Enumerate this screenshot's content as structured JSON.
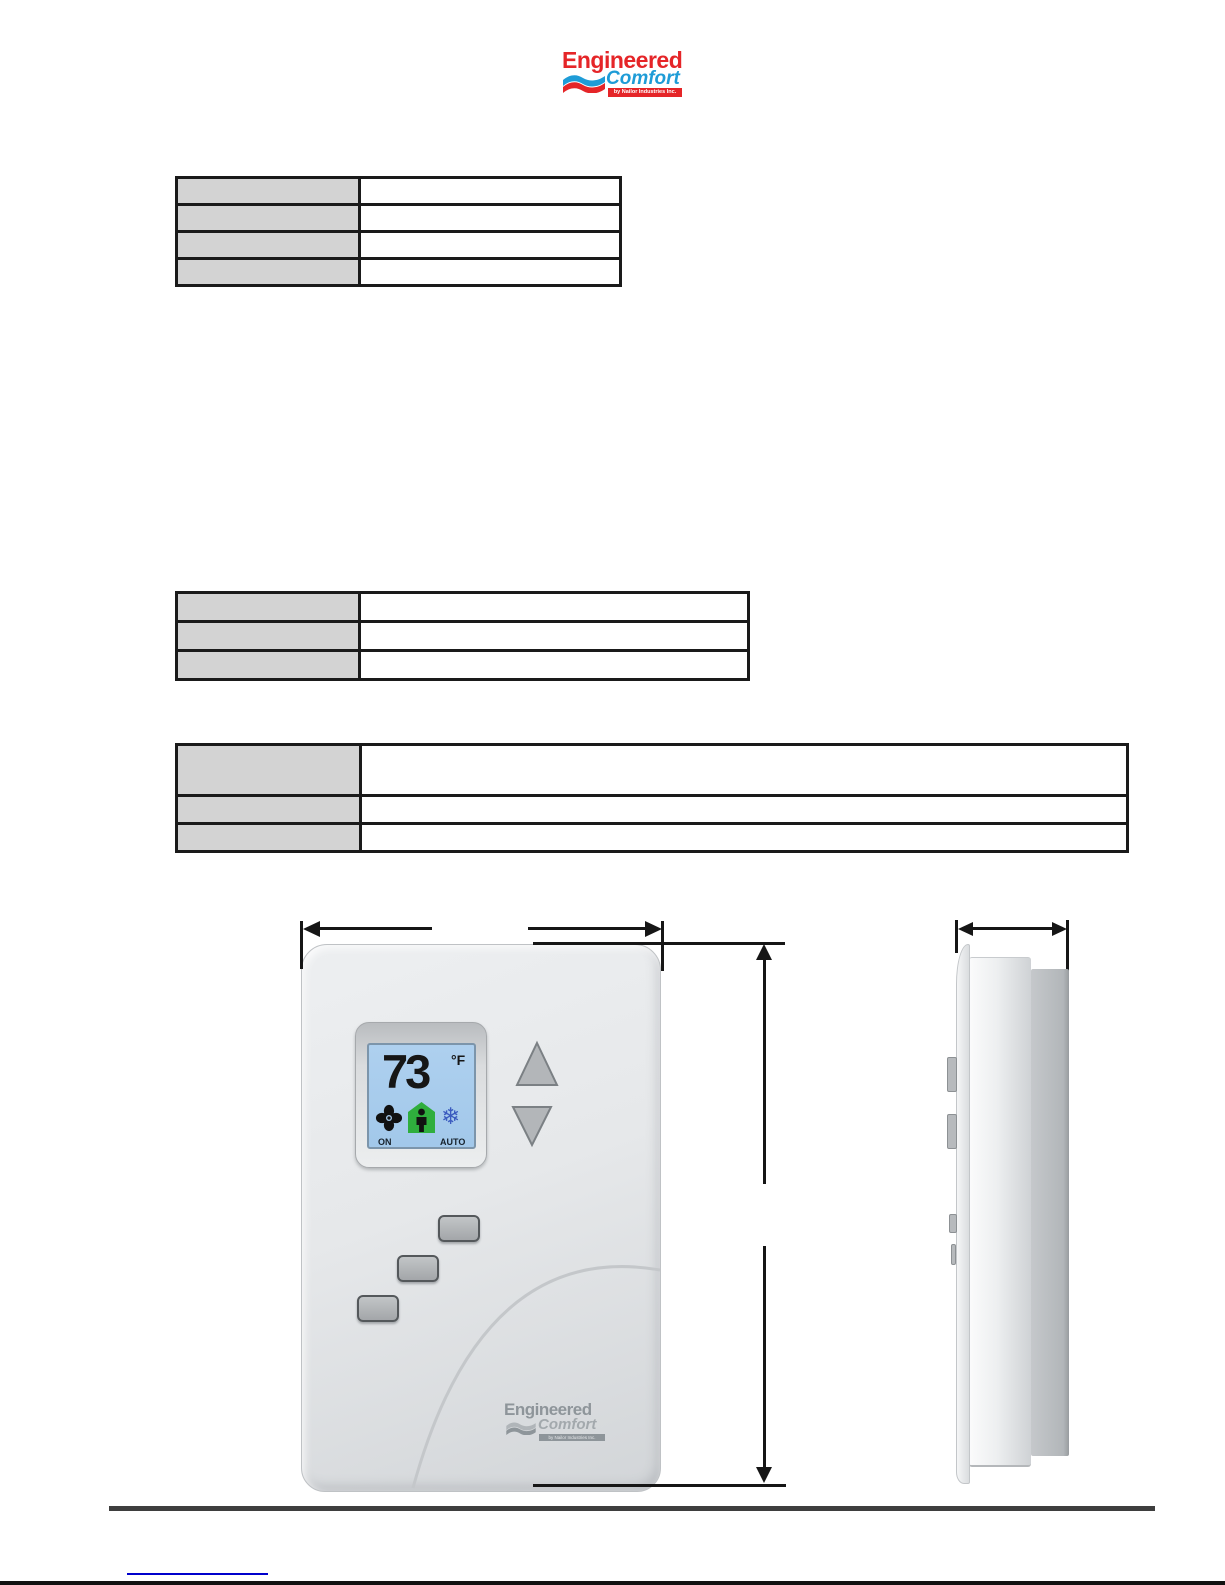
{
  "brand": {
    "name_top": "Engineered",
    "name_bottom": "Comfort",
    "tagline": "by Nailor Industries Inc."
  },
  "tables": {
    "table1": {
      "rows": [
        {
          "label": "",
          "value": ""
        },
        {
          "label": "",
          "value": ""
        },
        {
          "label": "",
          "value": ""
        },
        {
          "label": "",
          "value": ""
        }
      ]
    },
    "table2": {
      "rows": [
        {
          "label": "",
          "value": ""
        },
        {
          "label": "",
          "value": ""
        },
        {
          "label": "",
          "value": ""
        }
      ]
    },
    "table3": {
      "rows": [
        {
          "label": "",
          "value": ""
        },
        {
          "label": "",
          "value": ""
        },
        {
          "label": "",
          "value": ""
        }
      ]
    }
  },
  "thermostat": {
    "temperature": "73",
    "unit": "°F",
    "fan_status": "ON",
    "mode_status": "AUTO",
    "cool_glyph": "❄",
    "icons": [
      "fan-icon",
      "occupancy-icon",
      "snowflake-icon",
      "arrow-up-button",
      "arrow-down-button"
    ],
    "device_logo": {
      "name_top": "Engineered",
      "name_bottom": "Comfort",
      "tagline": "by Nailor Industries Inc."
    }
  },
  "footer": {
    "link_text": ""
  },
  "colors": {
    "logo_red": "#e52528",
    "logo_blue": "#1e9cd7",
    "table_header_gray": "#d3d3d3",
    "table_border": "#1a1a1a",
    "lcd_blue": "#a6cbec",
    "occupancy_green": "#2fae3d",
    "snowflake_blue": "#3b5bbf",
    "dimension_black": "#161616",
    "link_blue": "#0000cc"
  }
}
